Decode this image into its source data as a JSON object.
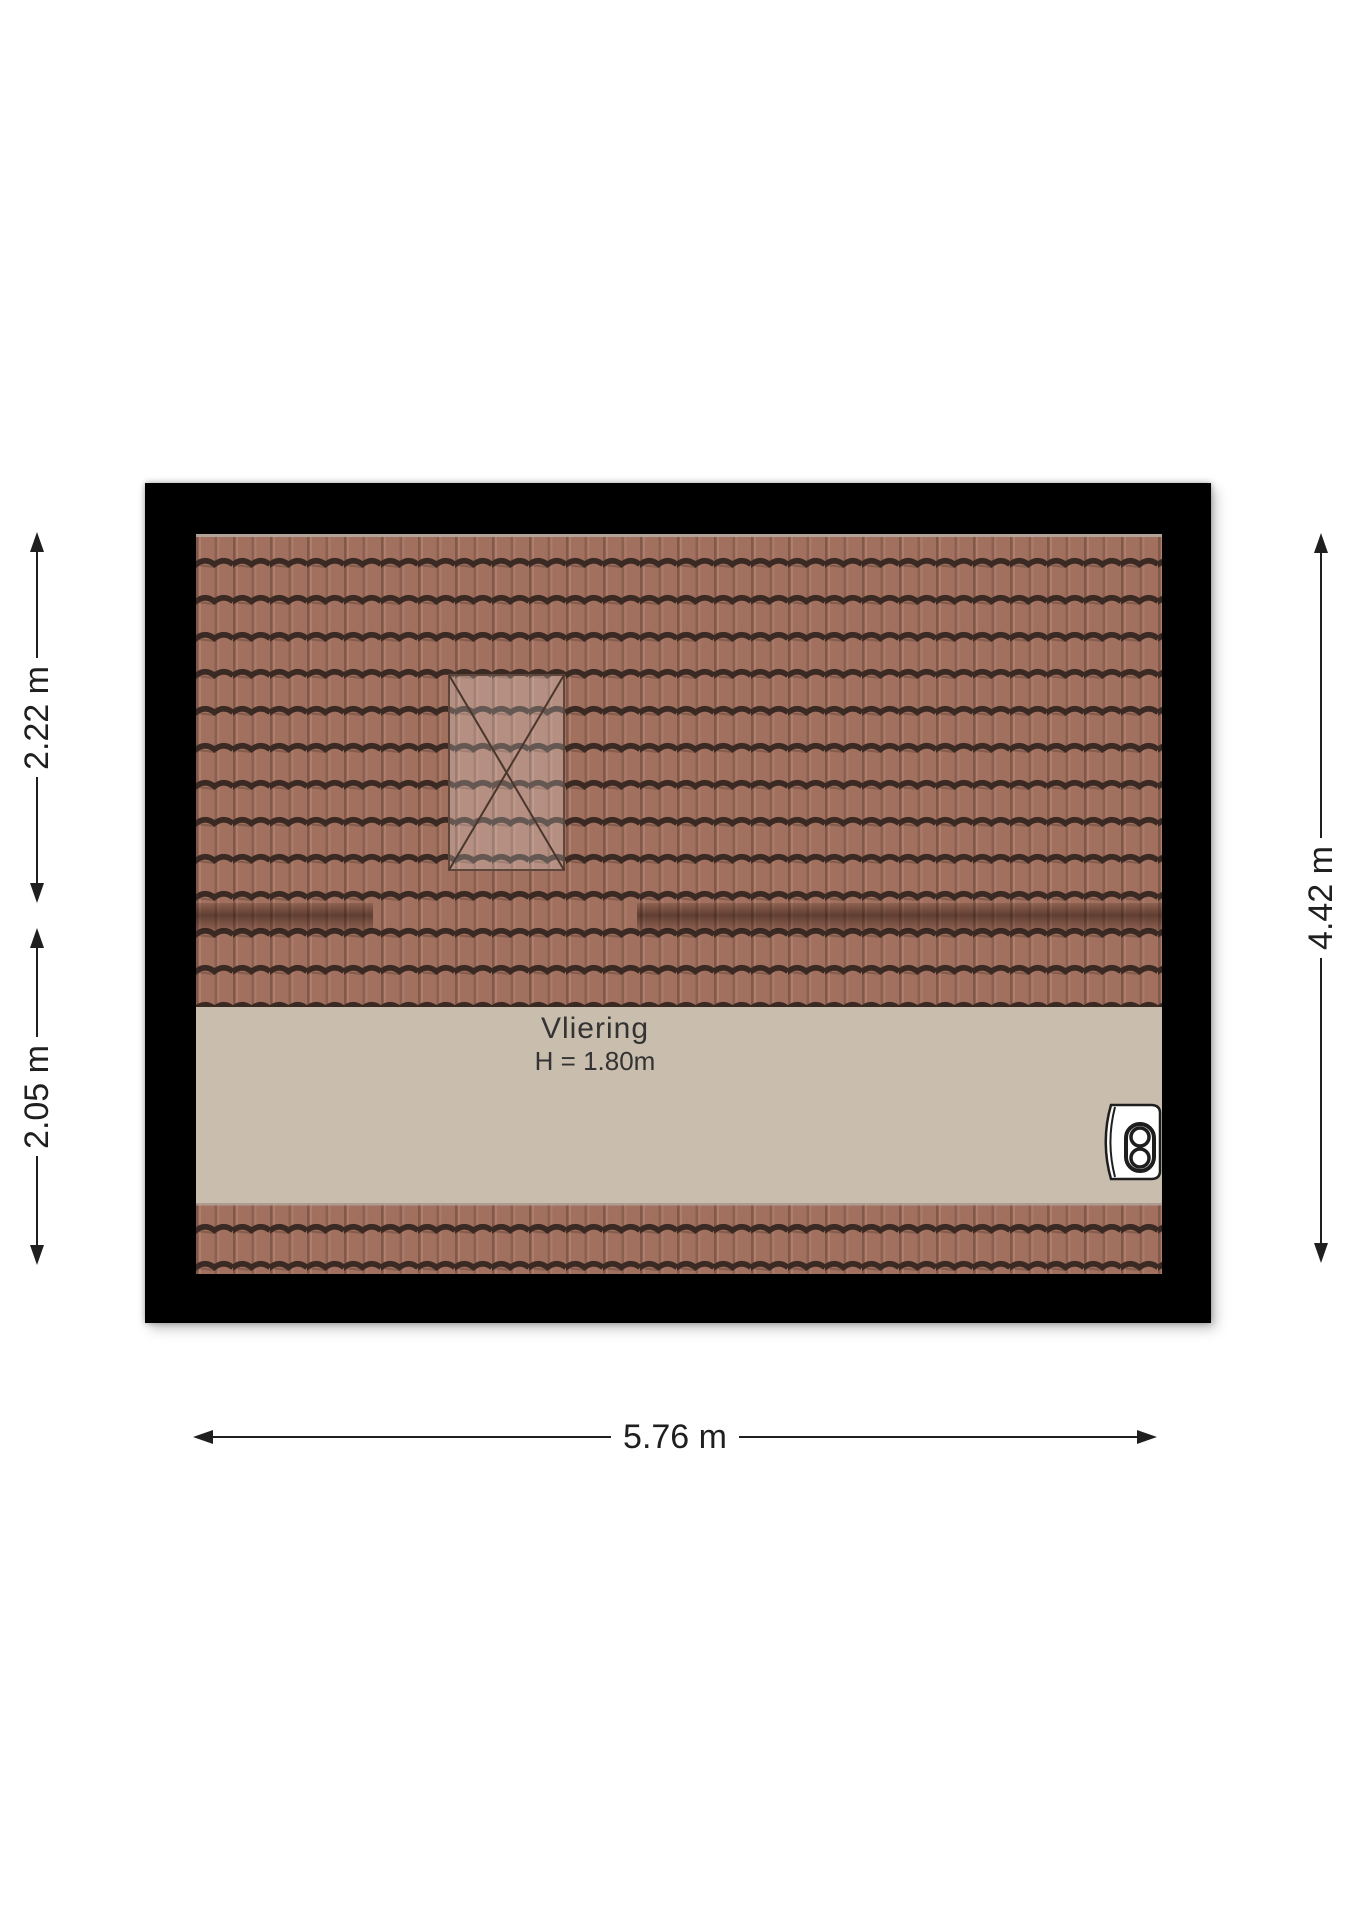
{
  "plan": {
    "type": "attic-floor-plan",
    "room": {
      "label": "Vliering",
      "height_note": "H = 1.80m"
    },
    "dimensions": {
      "left_upper": "2.22 m",
      "left_lower": "2.05 m",
      "right": "4.42 m",
      "bottom": "5.76 m"
    },
    "icons": {
      "boiler": "boiler-icon",
      "skylight": "skylight-window"
    },
    "colors": {
      "background": "#ffffff",
      "wall": "#000000",
      "roof_tile": "#a1705e",
      "roof_tile_groove": "#3a2a23",
      "floor": "#c9bdae",
      "dimension_text": "#1f1f1f",
      "room_text": "#333333"
    },
    "features": {
      "skylight_count": 1,
      "purlin_band_count": 2
    }
  }
}
